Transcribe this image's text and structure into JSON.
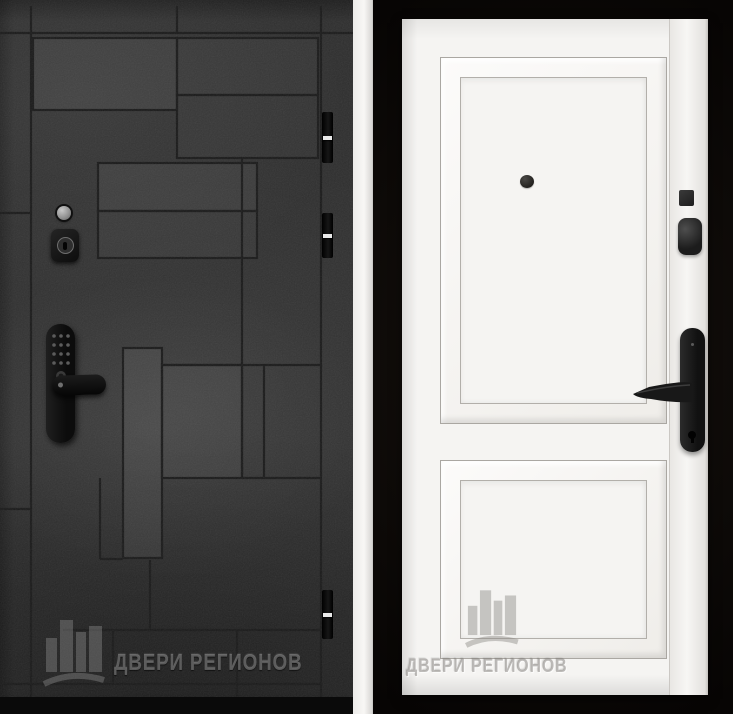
{
  "image_type": "door-catalog composite photo, two entrance doors side by side",
  "brand_watermark": "ДВЕРИ РЕГИОНОВ",
  "left_door": {
    "watermark": "ДВЕРИ РЕГИОНОВ",
    "description": "dark graphite door, concrete texture, engraved geometric block pattern",
    "colors": {
      "base": "#2e2e2e",
      "pattern_line": "#1a1a1a",
      "hardware": "#141414",
      "wall_strip": "#f1f0ee",
      "floor": "#0a0a0a"
    },
    "hardware": {
      "peephole": true,
      "cylinder_keyhole": true,
      "smart_lock_with_keypad_and_lever": true,
      "hinges": 3
    }
  },
  "right_door": {
    "watermark": "ДВЕРИ РЕГИОНОВ",
    "description": "white classic door with two raised molded panels",
    "colors": {
      "base": "#f5f4f2",
      "background": "#0b0807",
      "hardware": "#1c1c1c"
    },
    "hardware": {
      "peephole": true,
      "deadbolt_cylinder": true,
      "latch_square": true,
      "lever_handle_on_backplate_with_keyhole": true
    }
  }
}
